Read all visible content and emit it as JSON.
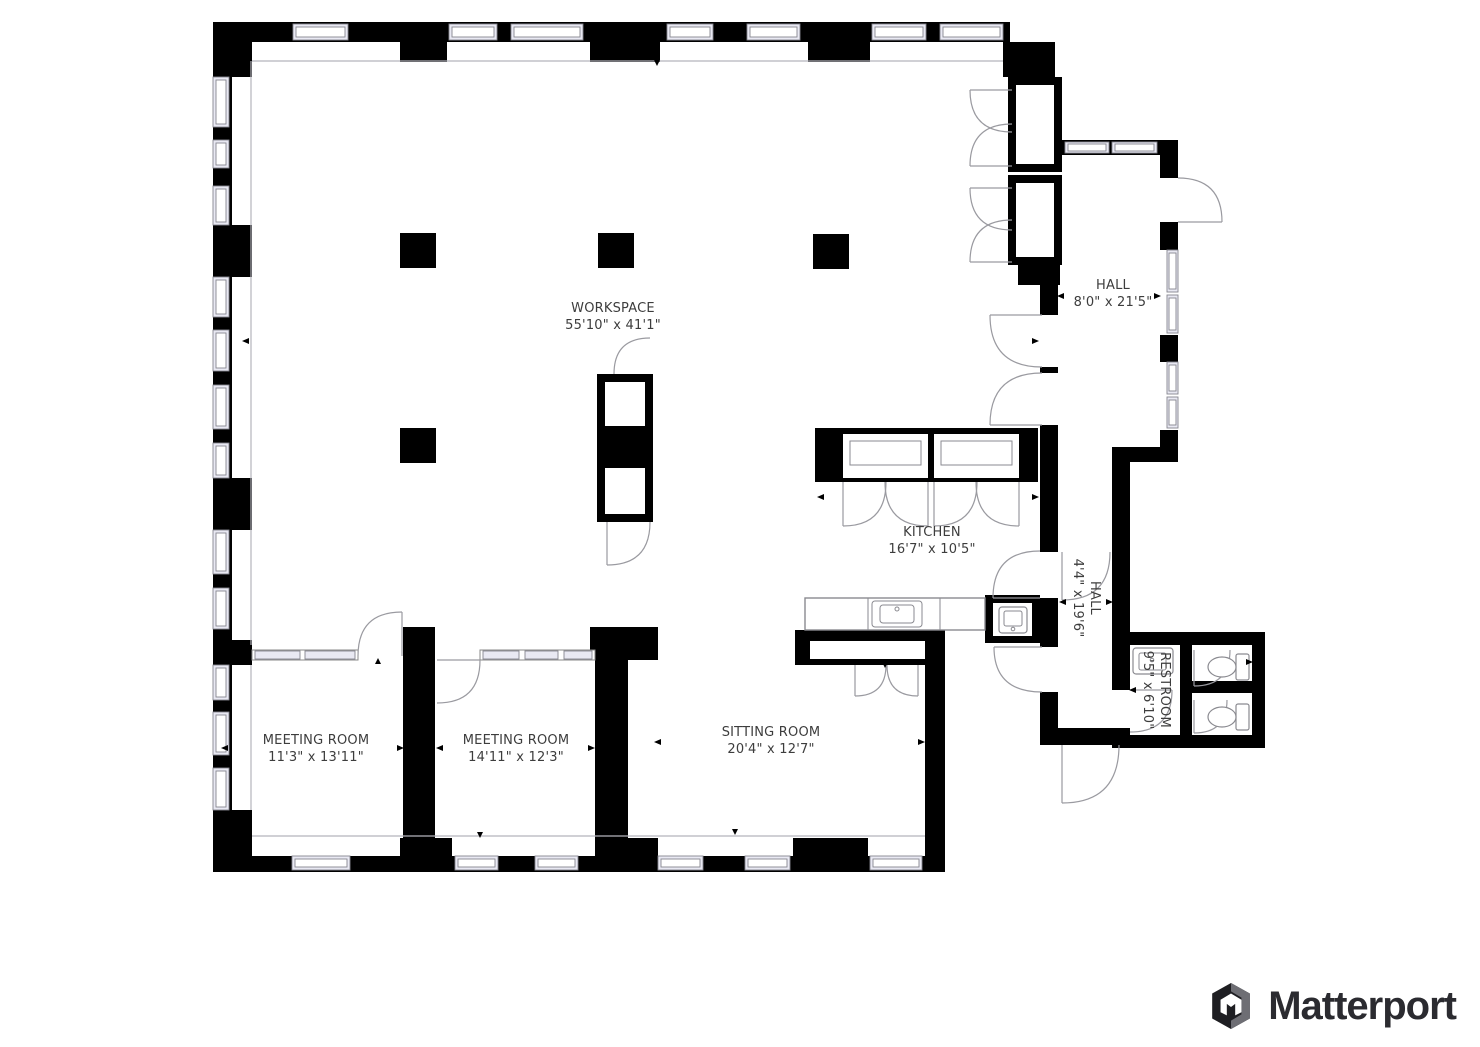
{
  "rooms": [
    {
      "name": "WORKSPACE",
      "dims": "55'10\" x 41'1\""
    },
    {
      "name": "HALL",
      "dims": "8'0\" x 21'5\""
    },
    {
      "name": "KITCHEN",
      "dims": "16'7\" x 10'5\""
    },
    {
      "name": "HALL",
      "dims": "4'4\" x 19'6\""
    },
    {
      "name": "RESTROOM",
      "dims": "9'5\" x 6'10\""
    },
    {
      "name": "MEETING ROOM",
      "dims": "11'3\" x 13'11\""
    },
    {
      "name": "MEETING ROOM",
      "dims": "14'11\" x 12'3\""
    },
    {
      "name": "SITTING ROOM",
      "dims": "20'4\" x 12'7\""
    }
  ],
  "branding": {
    "name": "Matterport"
  },
  "colors": {
    "wall": "#000000",
    "window_fill": "#e9e9f3",
    "window_frame": "#85858f",
    "door_arc": "#9a9aa0",
    "interior_line": "#b5b5bc",
    "label_text": "#3d3d3d"
  }
}
